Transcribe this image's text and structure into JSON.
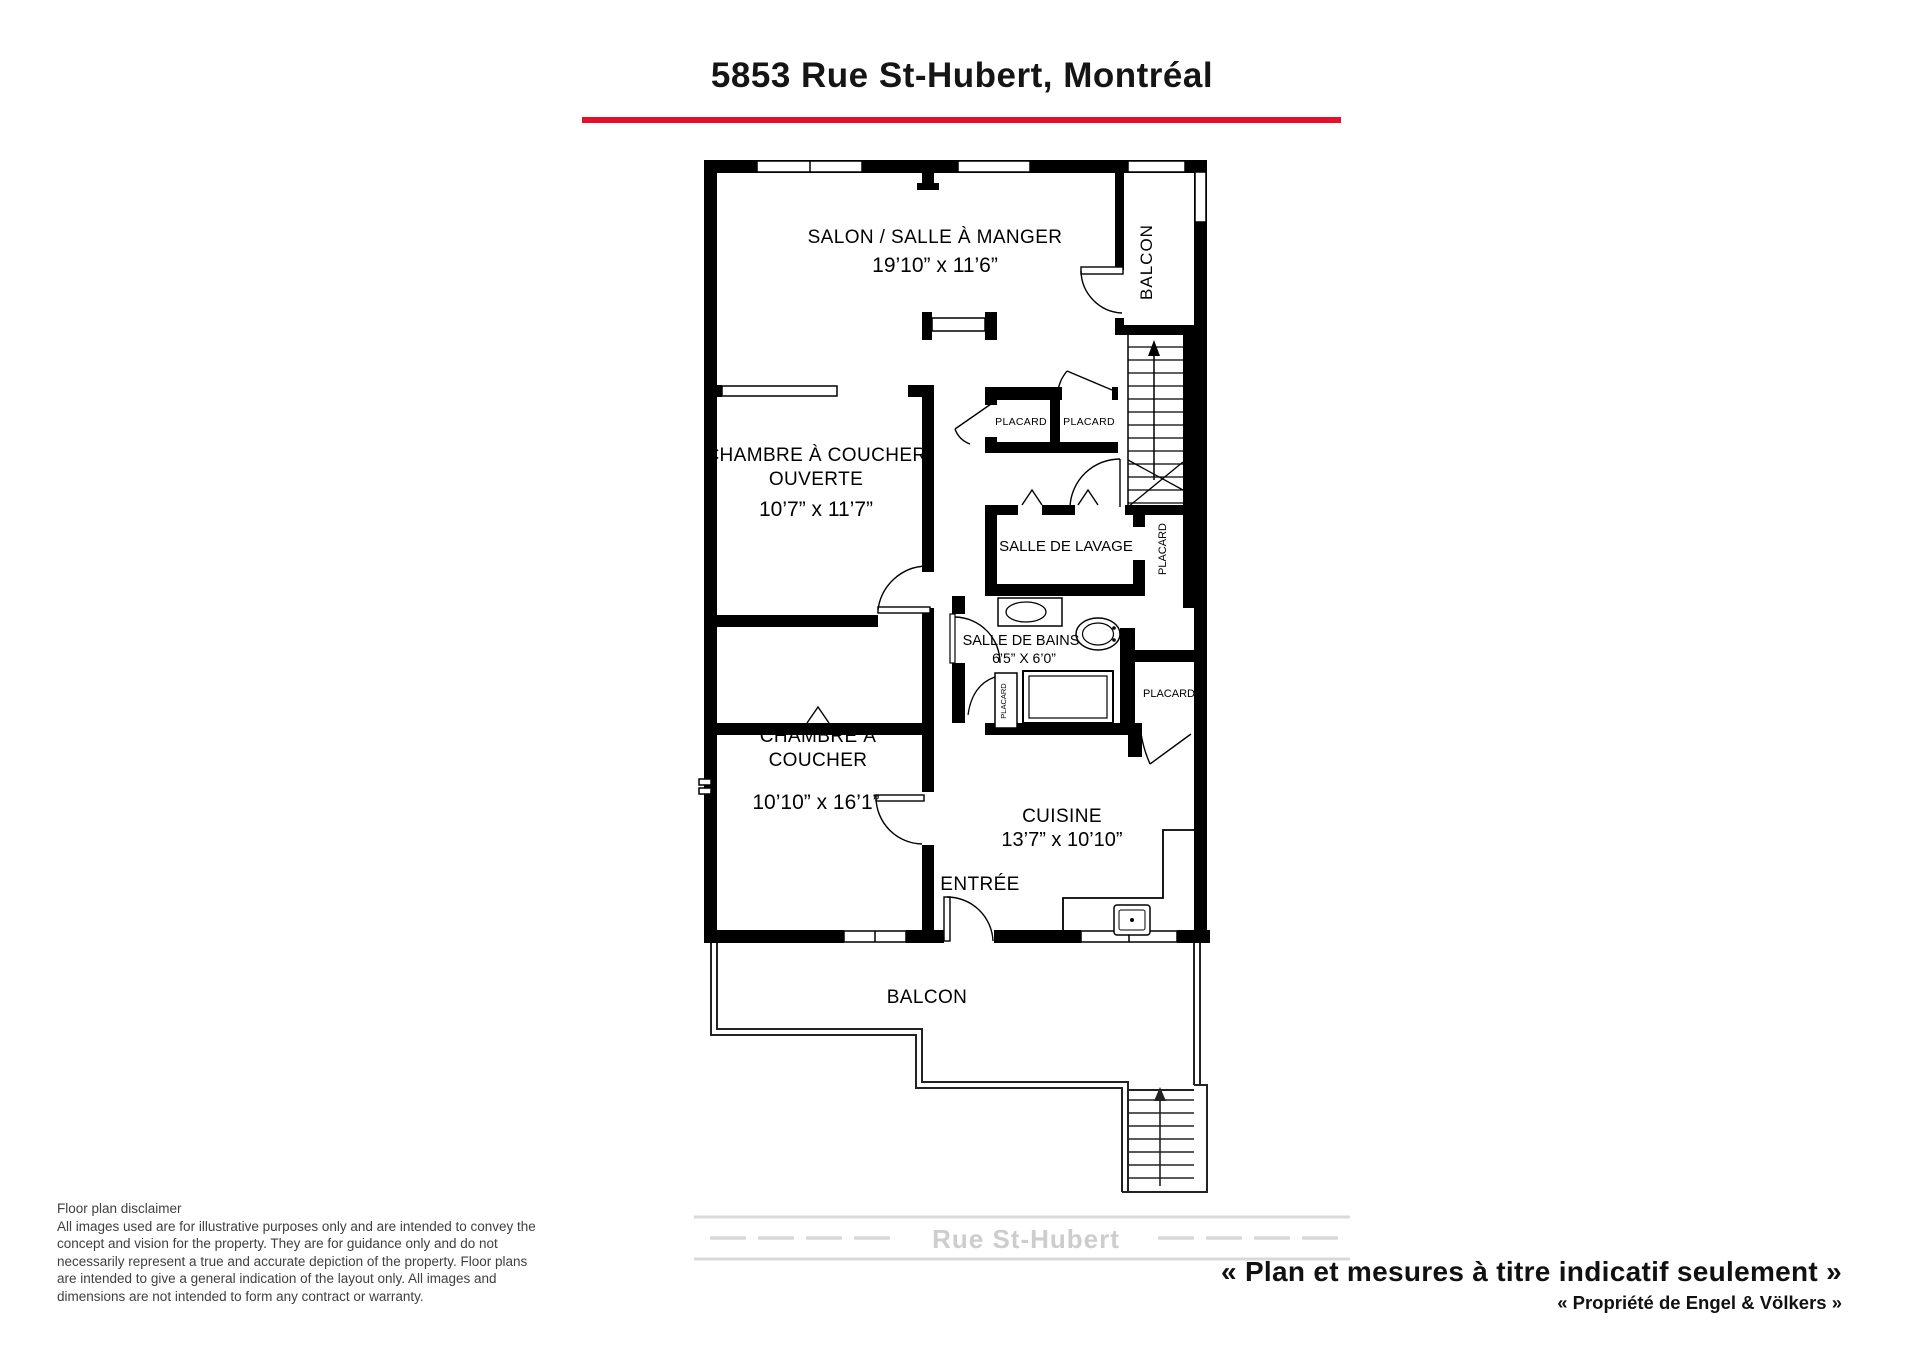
{
  "header": {
    "title": "5853 Rue St-Hubert, Montréal"
  },
  "colors": {
    "accent_red": "#e60f2d",
    "road_gray": "#d9d9d9",
    "road_text": "#cdcdcd"
  },
  "plan": {
    "rooms": {
      "salon": {
        "name": "SALON / SALLE À MANGER",
        "dims": "19’10” x 11’6”"
      },
      "balcon_top": {
        "name": "BALCON"
      },
      "placard_hall_left": {
        "name": "PLACARD"
      },
      "placard_hall_right": {
        "name": "PLACARD"
      },
      "chambre_ouverte": {
        "name_line1": "CHAMBRE À COUCHER",
        "name_line2": "OUVERTE",
        "dims": "10’7” x 11’7”"
      },
      "salle_de_lavage": {
        "name": "SALLE DE LAVAGE"
      },
      "placard_lavage": {
        "name": "PLACARD"
      },
      "salle_de_bains": {
        "name": "SALLE DE BAINS",
        "dims": "6’5” X 6’0”"
      },
      "placard_bains_petit": {
        "name": "PLACARD"
      },
      "placard_cuisine": {
        "name": "PLACARD"
      },
      "chambre": {
        "name_line1": "CHAMBRE À",
        "name_line2": "COUCHER",
        "dims": "10’10” x 16’1”"
      },
      "cuisine": {
        "name": "CUISINE",
        "dims": "13’7” x 10’10”"
      },
      "entree": {
        "name": "ENTRÉE"
      },
      "balcon_bottom": {
        "name": "BALCON"
      }
    },
    "street": {
      "name": "Rue St-Hubert"
    }
  },
  "footer": {
    "disclaimer_title": "Floor plan disclaimer",
    "disclaimer_body": "All images used are for illustrative purposes only and are intended to convey the concept and vision for the property. They are for guidance only and do not necessarily represent a true and accurate depiction of the property. Floor plans are intended to give a general indication of the layout only. All images and dimensions are not intended to form any contract or warranty.",
    "note_fr": "«  Plan et mesures à titre indicatif seulement »",
    "note_brand": "« Propriété de Engel & Völkers »"
  }
}
